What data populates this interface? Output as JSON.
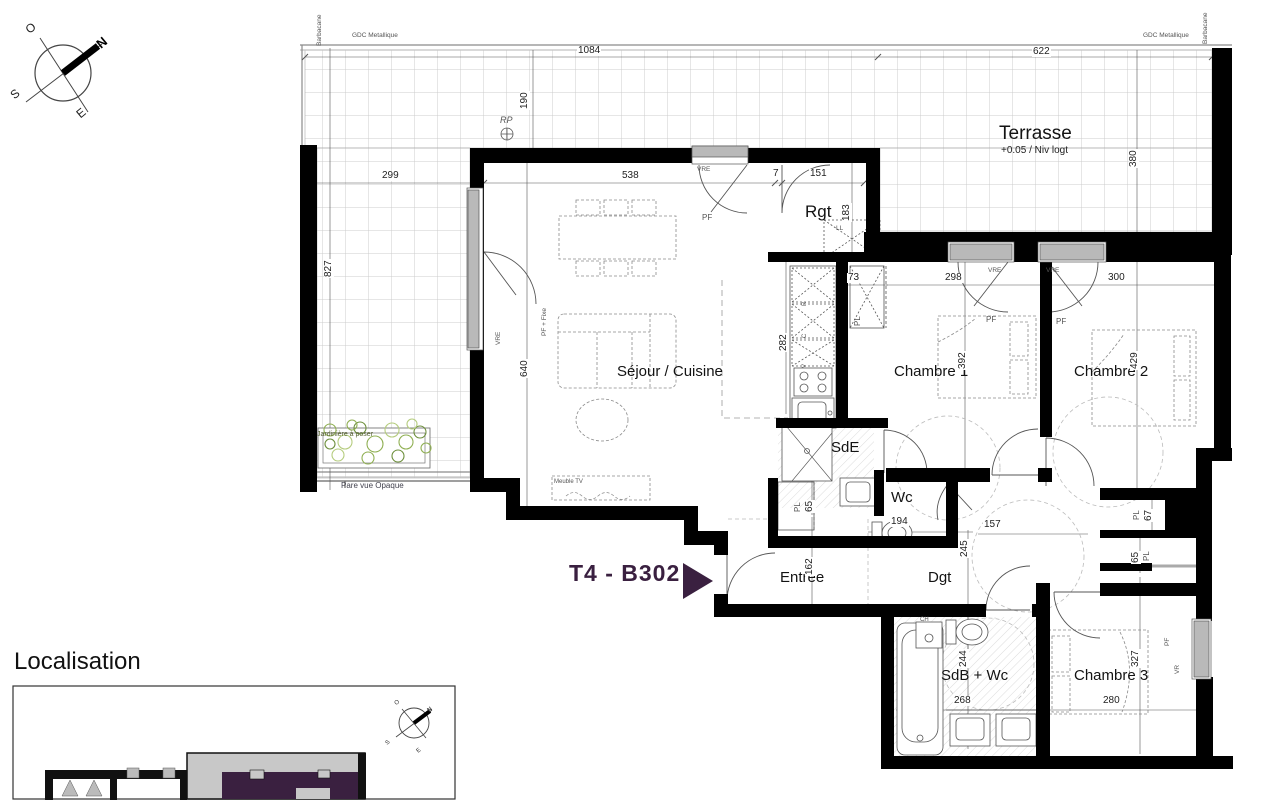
{
  "plan": {
    "unit": {
      "label": "T4 - B302"
    },
    "rooms": {
      "terrasse": {
        "name": "Terrasse",
        "level": "+0.05 / Niv logt"
      },
      "sejour": {
        "name": "Séjour / Cuisine"
      },
      "rgt": {
        "name": "Rgt"
      },
      "chambre1": {
        "name": "Chambre 1"
      },
      "chambre2": {
        "name": "Chambre 2"
      },
      "chambre3": {
        "name": "Chambre 3"
      },
      "sde": {
        "name": "SdE"
      },
      "wc": {
        "name": "Wc"
      },
      "entree": {
        "name": "Entrée"
      },
      "dgt": {
        "name": "Dgt"
      },
      "sdb": {
        "name": "SdB + Wc"
      }
    },
    "dims": {
      "t_w1": "1084",
      "t_w2": "622",
      "t_d": "190",
      "t_lw": "299",
      "t_lh": "827",
      "t_rd": "380",
      "sej_w": "538",
      "w7": "7",
      "rgt_w": "151",
      "rgt_h": "183",
      "pl73": "73",
      "c1_w": "298",
      "c2_w": "300",
      "kit_h": "282",
      "sej_h": "640",
      "c1_h": "392",
      "c2_h": "429",
      "pl65a": "65",
      "wc_w": "194",
      "dgt_h": "245",
      "dgt_w": "157",
      "pl67": "67",
      "pl65b": "65",
      "ent_h": "162",
      "sdb_h": "244",
      "sdb_w": "268",
      "c3_h": "327",
      "c3_w": "280"
    },
    "annotations": {
      "barbacane": "Barbacane",
      "gdc": "GDC Metallique",
      "rp": "RP",
      "pf": "PF",
      "vre": "VRE",
      "vr": "VR",
      "pl": "PL",
      "ll": "LL",
      "ch": "CH",
      "pf_fixe": "PF + Fixe",
      "meuble_tv": "Meuble TV",
      "kit_r": "R",
      "kit_c": "C",
      "kit_v": "V",
      "jardiniere": "Jardinière à poser",
      "pare_vue": "Pare vue Opaque"
    },
    "compass": {
      "n": "N",
      "s": "S",
      "e": "E",
      "o": "O"
    }
  },
  "localisation": {
    "title": "Localisation"
  },
  "colors": {
    "accent": "#3a2040",
    "wall": "#000000",
    "window": "#b9b9b9",
    "grid": "#cccccc",
    "foliage": "#8faf52"
  }
}
